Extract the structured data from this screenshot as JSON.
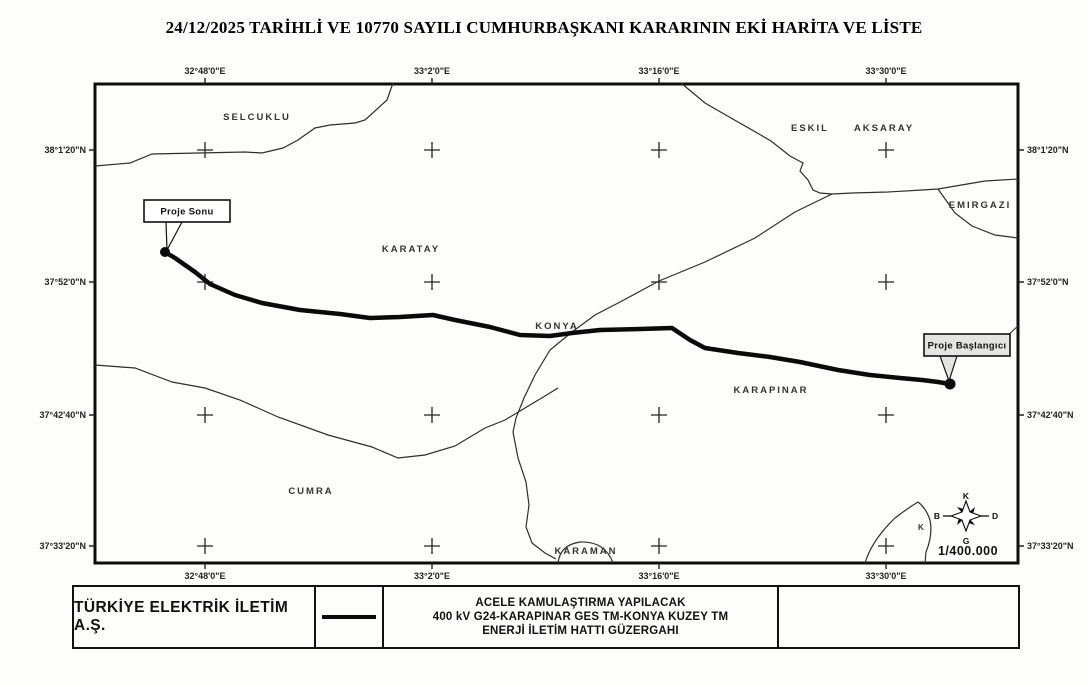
{
  "title": "24/12/2025 TARİHLİ VE 10770 SAYILI CUMHURBAŞKANI KARARININ EKİ HARİTA VE LİSTE",
  "map": {
    "lon_labels": [
      "32°48'0\"E",
      "33°2'0\"E",
      "33°16'0\"E",
      "33°30'0\"E"
    ],
    "lat_labels": [
      "38°1'20\"N",
      "37°52'0\"N",
      "37°42'40\"N",
      "37°33'20\"N"
    ],
    "places": {
      "selcuklu": "SELCUKLU",
      "eskil": "ESKIL",
      "aksaray": "AKSARAY",
      "emirgazi": "EMIRGAZI",
      "karatay": "KARATAY",
      "konya": "KONYA",
      "karapinar": "KARAPINAR",
      "cumra": "CUMRA",
      "karaman": "KARAMAN"
    },
    "callouts": {
      "project_end": "Proje Sonu",
      "project_start": "Proje Başlangıcı"
    },
    "road_label": "K",
    "compass": {
      "north": "K",
      "east": "D",
      "south": "G",
      "west": "B"
    },
    "scale": "1/400.000"
  },
  "legend": {
    "organization": "TÜRKİYE ELEKTRİK İLETİM A.Ş.",
    "line_symbol_icon": "transmission-line-symbol",
    "description_lines": [
      "ACELE KAMULAŞTIRMA YAPILACAK",
      "400 kV G24-KARAPINAR GES TM-KONYA KUZEY TM",
      "ENERJİ İLETİM HATTI GÜZERGAHI"
    ]
  },
  "colors": {
    "ink": "#111111",
    "thin_line": "#2e2e2e",
    "route_line": "#0a0a0a",
    "callout_fill": "#e4e4e2"
  }
}
